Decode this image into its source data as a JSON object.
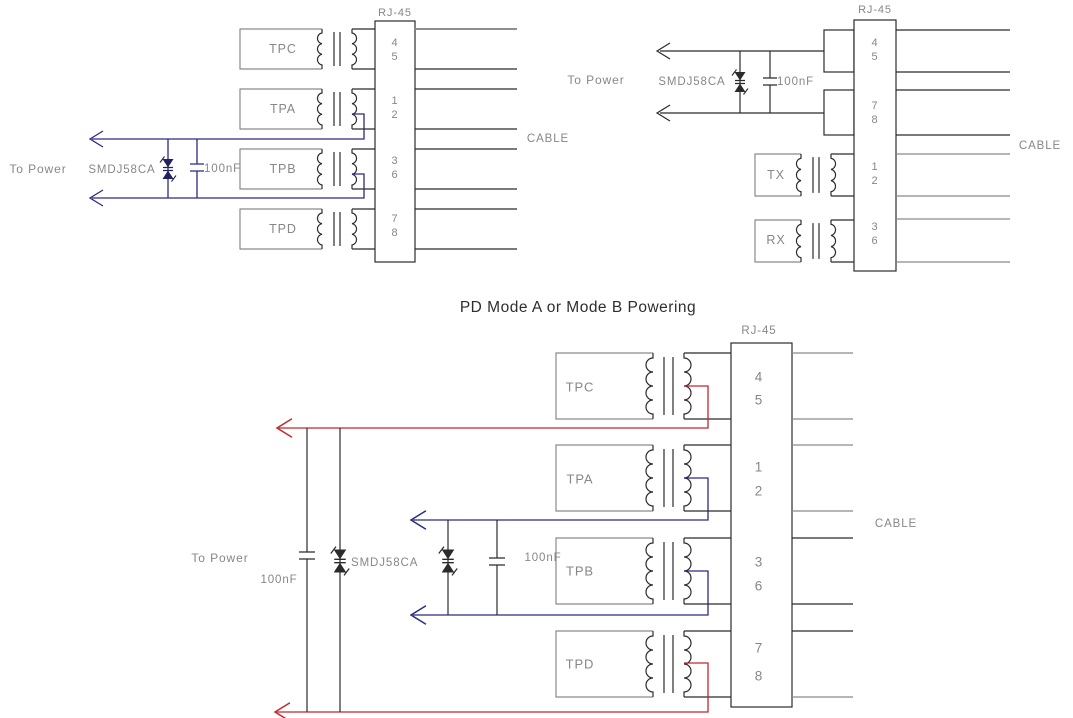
{
  "colors": {
    "background": "#ffffff",
    "power_navy": "#2b2b80",
    "power_red": "#c4262c",
    "line_gray": "#8a8a8a",
    "line_black": "#2b2b2b",
    "text_gray": "#878787",
    "title_black": "#2e2e2e"
  },
  "d1": {
    "rj45_label": "RJ-45",
    "pins": [
      "4",
      "5",
      "1",
      "2",
      "3",
      "6",
      "7",
      "8"
    ],
    "blocks": [
      "TPC",
      "TPA",
      "TPB",
      "TPD"
    ],
    "to_power_label": "To Power",
    "tvs_label": "SMDJ58CA",
    "cap_label": "100nF",
    "cable_label": "CABLE"
  },
  "d2": {
    "rj45_label": "RJ-45",
    "pins": [
      "4",
      "5",
      "7",
      "8",
      "1",
      "2",
      "3",
      "6"
    ],
    "blocks": [
      "TX",
      "RX"
    ],
    "to_power_label": "To Power",
    "tvs_label": "SMDJ58CA",
    "cap_label": "100nF",
    "cable_label": "CABLE"
  },
  "d3": {
    "title": "PD Mode A or Mode B Powering",
    "rj45_label": "RJ-45",
    "pins": [
      "4",
      "5",
      "1",
      "2",
      "3",
      "6",
      "7",
      "8"
    ],
    "blocks": [
      "TPC",
      "TPA",
      "TPB",
      "TPD"
    ],
    "to_power_label": "To Power",
    "cap1_label": "100nF",
    "tvs_label": "SMDJ58CA",
    "cap2_label": "100nF",
    "cable_label": "CABLE"
  }
}
